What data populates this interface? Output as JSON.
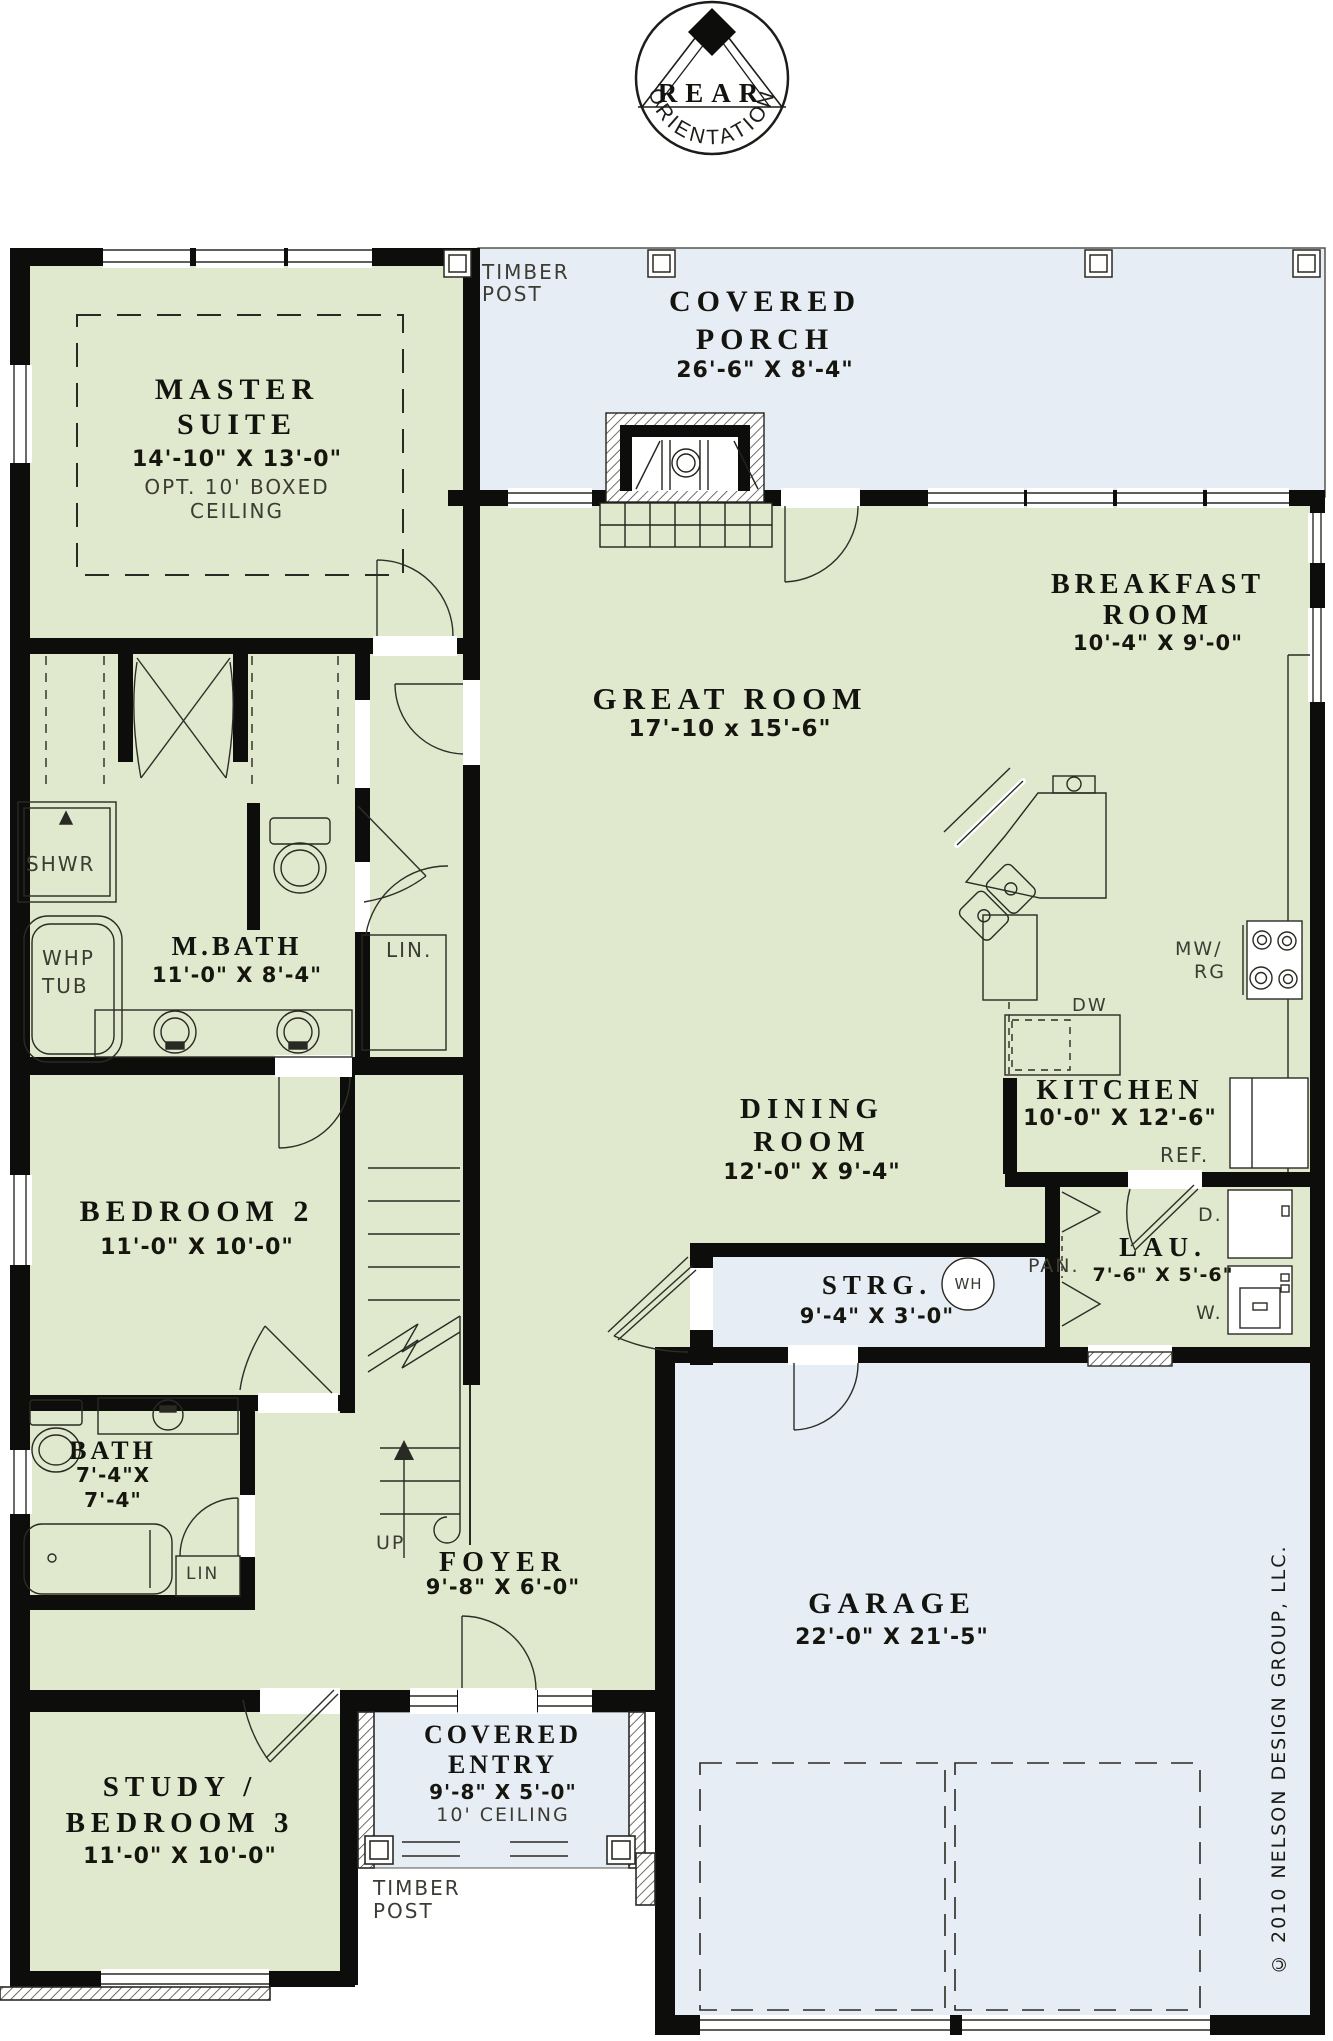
{
  "colors": {
    "room_fill": "#e0e8cd",
    "porch_fill": "#e7edf4",
    "wall": "#0d0d0b",
    "line": "#23231e"
  },
  "compass": {
    "title": "REAR",
    "subtitle": "ORIENTATION"
  },
  "rooms": {
    "covered_porch": {
      "line1": "COVERED",
      "line2": "PORCH",
      "dims": "26'-6\" X 8'-4\""
    },
    "master_suite": {
      "line1": "MASTER",
      "line2": "SUITE",
      "dims": "14'-10\" X 13'-0\"",
      "note1": "OPT. 10' BOXED",
      "note2": "CEILING"
    },
    "great_room": {
      "line1": "GREAT ROOM",
      "dims": "17'-10 x 15'-6\""
    },
    "breakfast": {
      "line1": "BREAKFAST",
      "line2": "ROOM",
      "dims": "10'-4\" X 9'-0\""
    },
    "kitchen": {
      "line1": "KITCHEN",
      "dims": "10'-0\" X 12'-6\""
    },
    "dining": {
      "line1": "DINING",
      "line2": "ROOM",
      "dims": "12'-0\" X 9'-4\""
    },
    "master_bath": {
      "line1": "M.BATH",
      "dims": "11'-0\" X 8'-4\""
    },
    "bedroom2": {
      "line1": "BEDROOM 2",
      "dims": "11'-0\" X 10'-0\""
    },
    "bath": {
      "line1": "BATH",
      "dims1": "7'-4\"X",
      "dims2": "7'-4\""
    },
    "foyer": {
      "line1": "FOYER",
      "dims": "9'-8\" X 6'-0\""
    },
    "storage": {
      "line1": "STRG.",
      "dims": "9'-4\" X 3'-0\""
    },
    "laundry": {
      "line1": "LAU.",
      "dims": "7'-6\" X 5'-6\""
    },
    "garage": {
      "line1": "GARAGE",
      "dims": "22'-0\" X 21'-5\""
    },
    "study": {
      "line1": "STUDY /",
      "line2": "BEDROOM 3",
      "dims": "11'-0\" X 10'-0\""
    },
    "covered_entry": {
      "line1": "COVERED",
      "line2": "ENTRY",
      "dims": "9'-8\" X 5'-0\"",
      "note": "10' CEILING"
    }
  },
  "fixtures": {
    "shower": "SHWR",
    "whirlpool1": "WHP",
    "whirlpool2": "TUB",
    "linen_mbath": "LIN.",
    "linen_bath": "LIN",
    "refrigerator": "REF.",
    "dishwasher": "DW",
    "microwave_range1": "MW/",
    "microwave_range2": "RG",
    "pantry": "PAN.",
    "dryer": "D.",
    "washer": "W.",
    "water_heater": "WH",
    "stairs_up": "UP",
    "timber_post1": "TIMBER",
    "timber_post2": "POST"
  },
  "copyright": "© 2010 NELSON DESIGN GROUP, LLC."
}
